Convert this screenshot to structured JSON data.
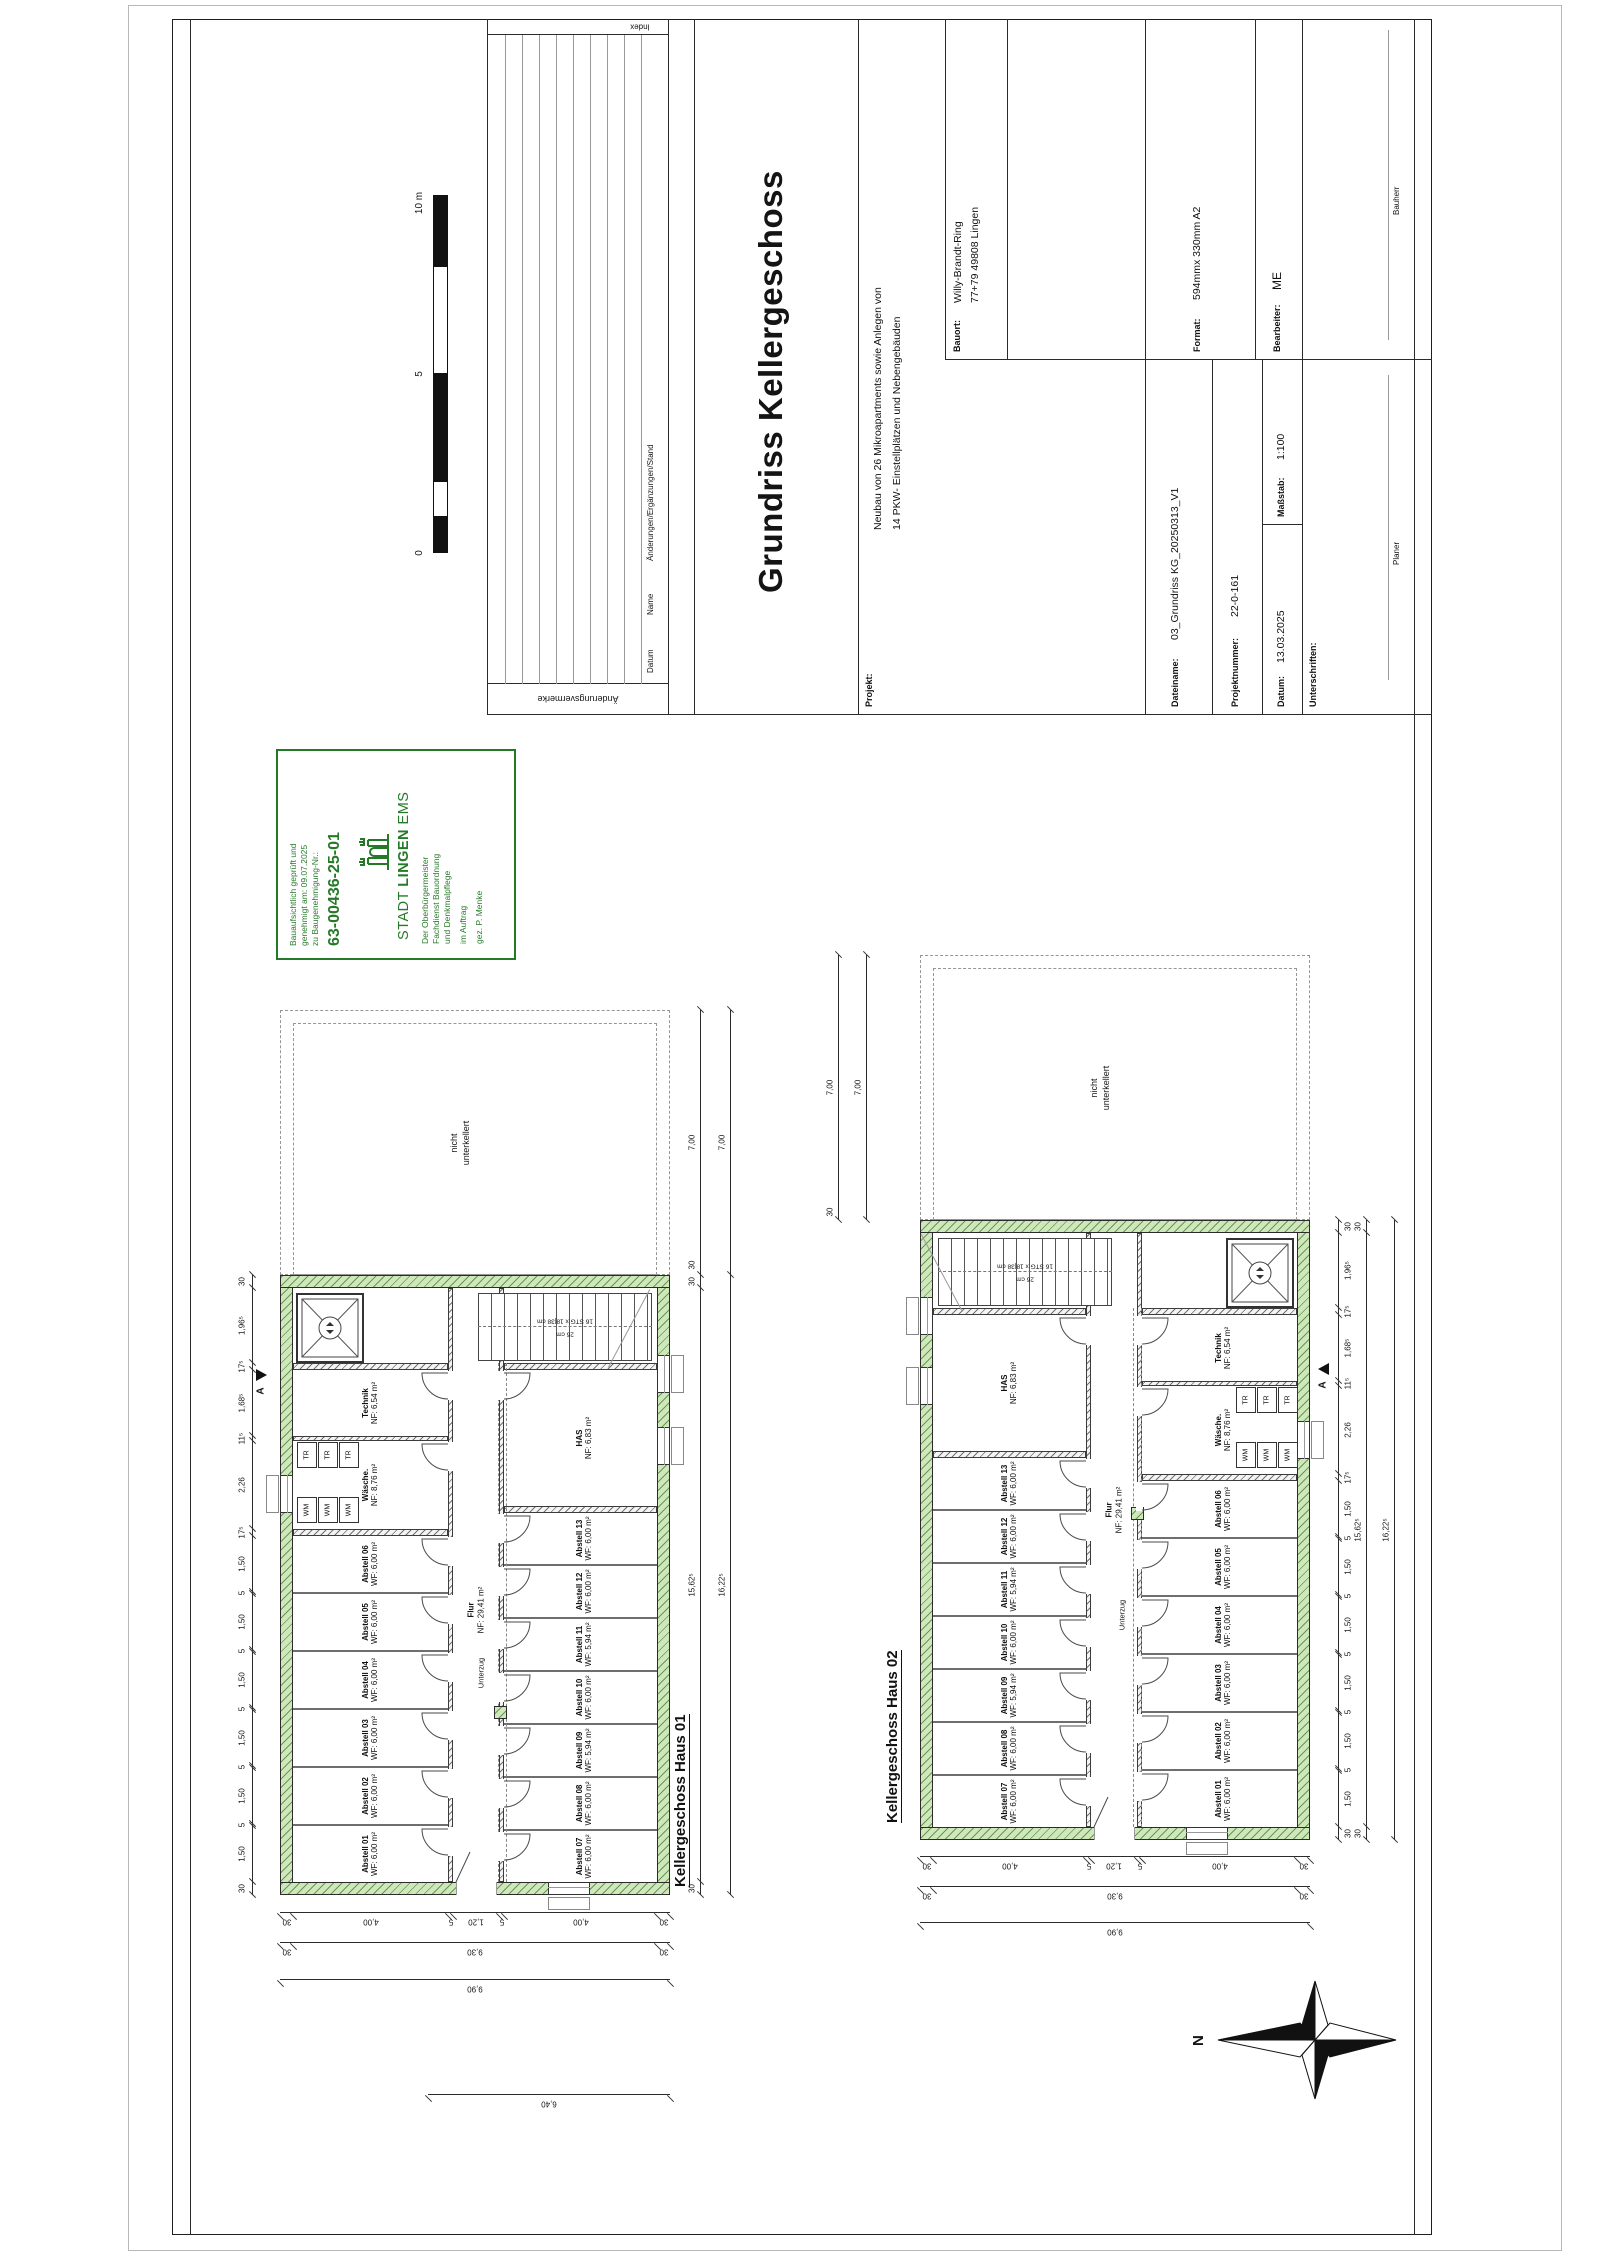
{
  "titleblock": {
    "title": "Grundriss Kellergeschoss",
    "projekt_label": "Projekt:",
    "projekt": [
      "Neubau von 26 Mikroapartments sowie Anlegen von",
      "14 PKW- Einstellplätzen und Nebengebäuden"
    ],
    "bauort_label": "Bauort:",
    "bauort": [
      "Willy-Brandt-Ring",
      "77+79 49808 Lingen"
    ],
    "dateiname_label": "Dateiname:",
    "dateiname": "03_Grundriss KG_20250313_V1",
    "projektnummer_label": "Projektnummer:",
    "projektnummer": "22-0-161",
    "datum_label": "Datum:",
    "datum": "13.03.2025",
    "massstab_label": "Maßstab:",
    "massstab": "1:100",
    "format_label": "Format:",
    "format": "594mmx 330mm A2",
    "bearbeiter_label": "Bearbeiter:",
    "bearbeiter": "ME",
    "unterschriften_label": "Unterschriften:",
    "planer_label": "Planer",
    "bauherr_label": "Bauherr"
  },
  "revisions": {
    "side_label": "Änderungsvermerke",
    "col_datum": "Datum",
    "col_name": "Name",
    "col_aenderungen": "Änderungen/Ergänzungen/Stand",
    "col_index": "Index"
  },
  "stamp": {
    "lines": [
      "Bauaufsichtlich geprüft und",
      "genehmigt am: 09.07.2025",
      "zu Baugenehmigung-Nr.:"
    ],
    "number": "63-00436-25-01",
    "city": [
      "STADT",
      "LINGEN",
      "EMS"
    ],
    "office": [
      "Der Oberbürgermeister",
      "Fachdienst Bauordnung",
      "und Denkmalpflege",
      "im Auftrag",
      "gez. P. Menke"
    ],
    "color": "#257a28"
  },
  "scalebar": {
    "zero": "0",
    "mid": "5",
    "end": "10 m"
  },
  "north": "N",
  "dims": {
    "room_chain": [
      "30",
      "1,50",
      "5",
      "1,50",
      "5",
      "1,50",
      "5",
      "1,50",
      "5",
      "1,50",
      "5",
      "1,50",
      "17⁵",
      "2,26",
      "11⁵",
      "1,68⁵",
      "17⁵",
      "1,96⁵",
      "30"
    ],
    "length_inner": [
      "30",
      "15,62⁵",
      "30"
    ],
    "length_outer": "16,22⁵",
    "depth_chain": [
      "30",
      "4,00",
      "5",
      "1,20",
      "5",
      "4,00",
      "30"
    ],
    "width_inner": [
      "30",
      "9,30",
      "30"
    ],
    "width_outer": "9,90",
    "offset": "6,40",
    "unexcavated_depth": "7,00",
    "wall": "30"
  },
  "plans": [
    {
      "heading": "Kellergeschoss Haus 01",
      "top_rooms": [
        {
          "name": "Abstell 01",
          "area": "WF: 6,00 m²"
        },
        {
          "name": "Abstell 02",
          "area": "WF: 6,00 m²"
        },
        {
          "name": "Abstell 03",
          "area": "WF: 6,00 m²"
        },
        {
          "name": "Abstell 04",
          "area": "WF: 6,00 m²"
        },
        {
          "name": "Abstell 05",
          "area": "WF: 6,00 m²"
        },
        {
          "name": "Abstell 06",
          "area": "WF: 6,00 m²"
        },
        {
          "name": "Wäsche.",
          "area": "NF: 8,76 m²"
        },
        {
          "name": "Technik",
          "area": "NF: 6,54 m²"
        }
      ],
      "bottom_rooms": [
        {
          "name": "Abstell 07",
          "area": "WF: 6,00 m²"
        },
        {
          "name": "Abstell 08",
          "area": "WF: 6,00 m²"
        },
        {
          "name": "Abstell 09",
          "area": "WF: 5,94 m²"
        },
        {
          "name": "Abstell 10",
          "area": "WF: 6,00 m²"
        },
        {
          "name": "Abstell 11",
          "area": "WF: 5,94 m²"
        },
        {
          "name": "Abstell 12",
          "area": "WF: 6,00 m²"
        },
        {
          "name": "Abstell 13",
          "area": "WF: 6,00 m²"
        },
        {
          "name": "HAS",
          "area": "NF: 6,83 m²"
        }
      ],
      "flur_name": "Flur",
      "flur_area": "NF: 29,41 m²",
      "unterzug": "Unterzug",
      "nicht_unterkellert": [
        "nicht",
        "unterkellert"
      ],
      "stair_note": "16 STG x 18|38 cm",
      "stair_note2": "26 cm",
      "wm": "WM",
      "tr": "TR",
      "section": "A"
    },
    {
      "heading": "Kellergeschoss Haus 02",
      "top_rooms": [
        {
          "name": "Abstell 07",
          "area": "WF: 6,00 m²"
        },
        {
          "name": "Abstell 08",
          "area": "WF: 6,00 m²"
        },
        {
          "name": "Abstell 09",
          "area": "WF: 5,94 m²"
        },
        {
          "name": "Abstell 10",
          "area": "WF: 6,00 m²"
        },
        {
          "name": "Abstell 11",
          "area": "WF: 5,94 m²"
        },
        {
          "name": "Abstell 12",
          "area": "WF: 6,00 m²"
        },
        {
          "name": "Abstell 13",
          "area": "WF: 6,00 m²"
        },
        {
          "name": "HAS",
          "area": "NF: 6,83 m²"
        }
      ],
      "bottom_rooms": [
        {
          "name": "Abstell 01",
          "area": "WF: 6,00 m²"
        },
        {
          "name": "Abstell 02",
          "area": "WF: 6,00 m²"
        },
        {
          "name": "Abstell 03",
          "area": "WF: 6,00 m²"
        },
        {
          "name": "Abstell 04",
          "area": "WF: 6,00 m²"
        },
        {
          "name": "Abstell 05",
          "area": "WF: 6,00 m²"
        },
        {
          "name": "Abstell 06",
          "area": "WF: 6,00 m²"
        },
        {
          "name": "Wäsche.",
          "area": "NF: 8,76 m²"
        },
        {
          "name": "Technik",
          "area": "NF: 6,54 m²"
        }
      ],
      "flur_name": "Flur",
      "flur_area": "NF: 29,41 m²",
      "unterzug": "Unterzug",
      "nicht_unterkellert": [
        "nicht",
        "unterkellert"
      ],
      "stair_note": "16 STG x 18|38 cm",
      "stair_note2": "26 cm",
      "wm": "WM",
      "tr": "TR",
      "section": "A"
    }
  ]
}
